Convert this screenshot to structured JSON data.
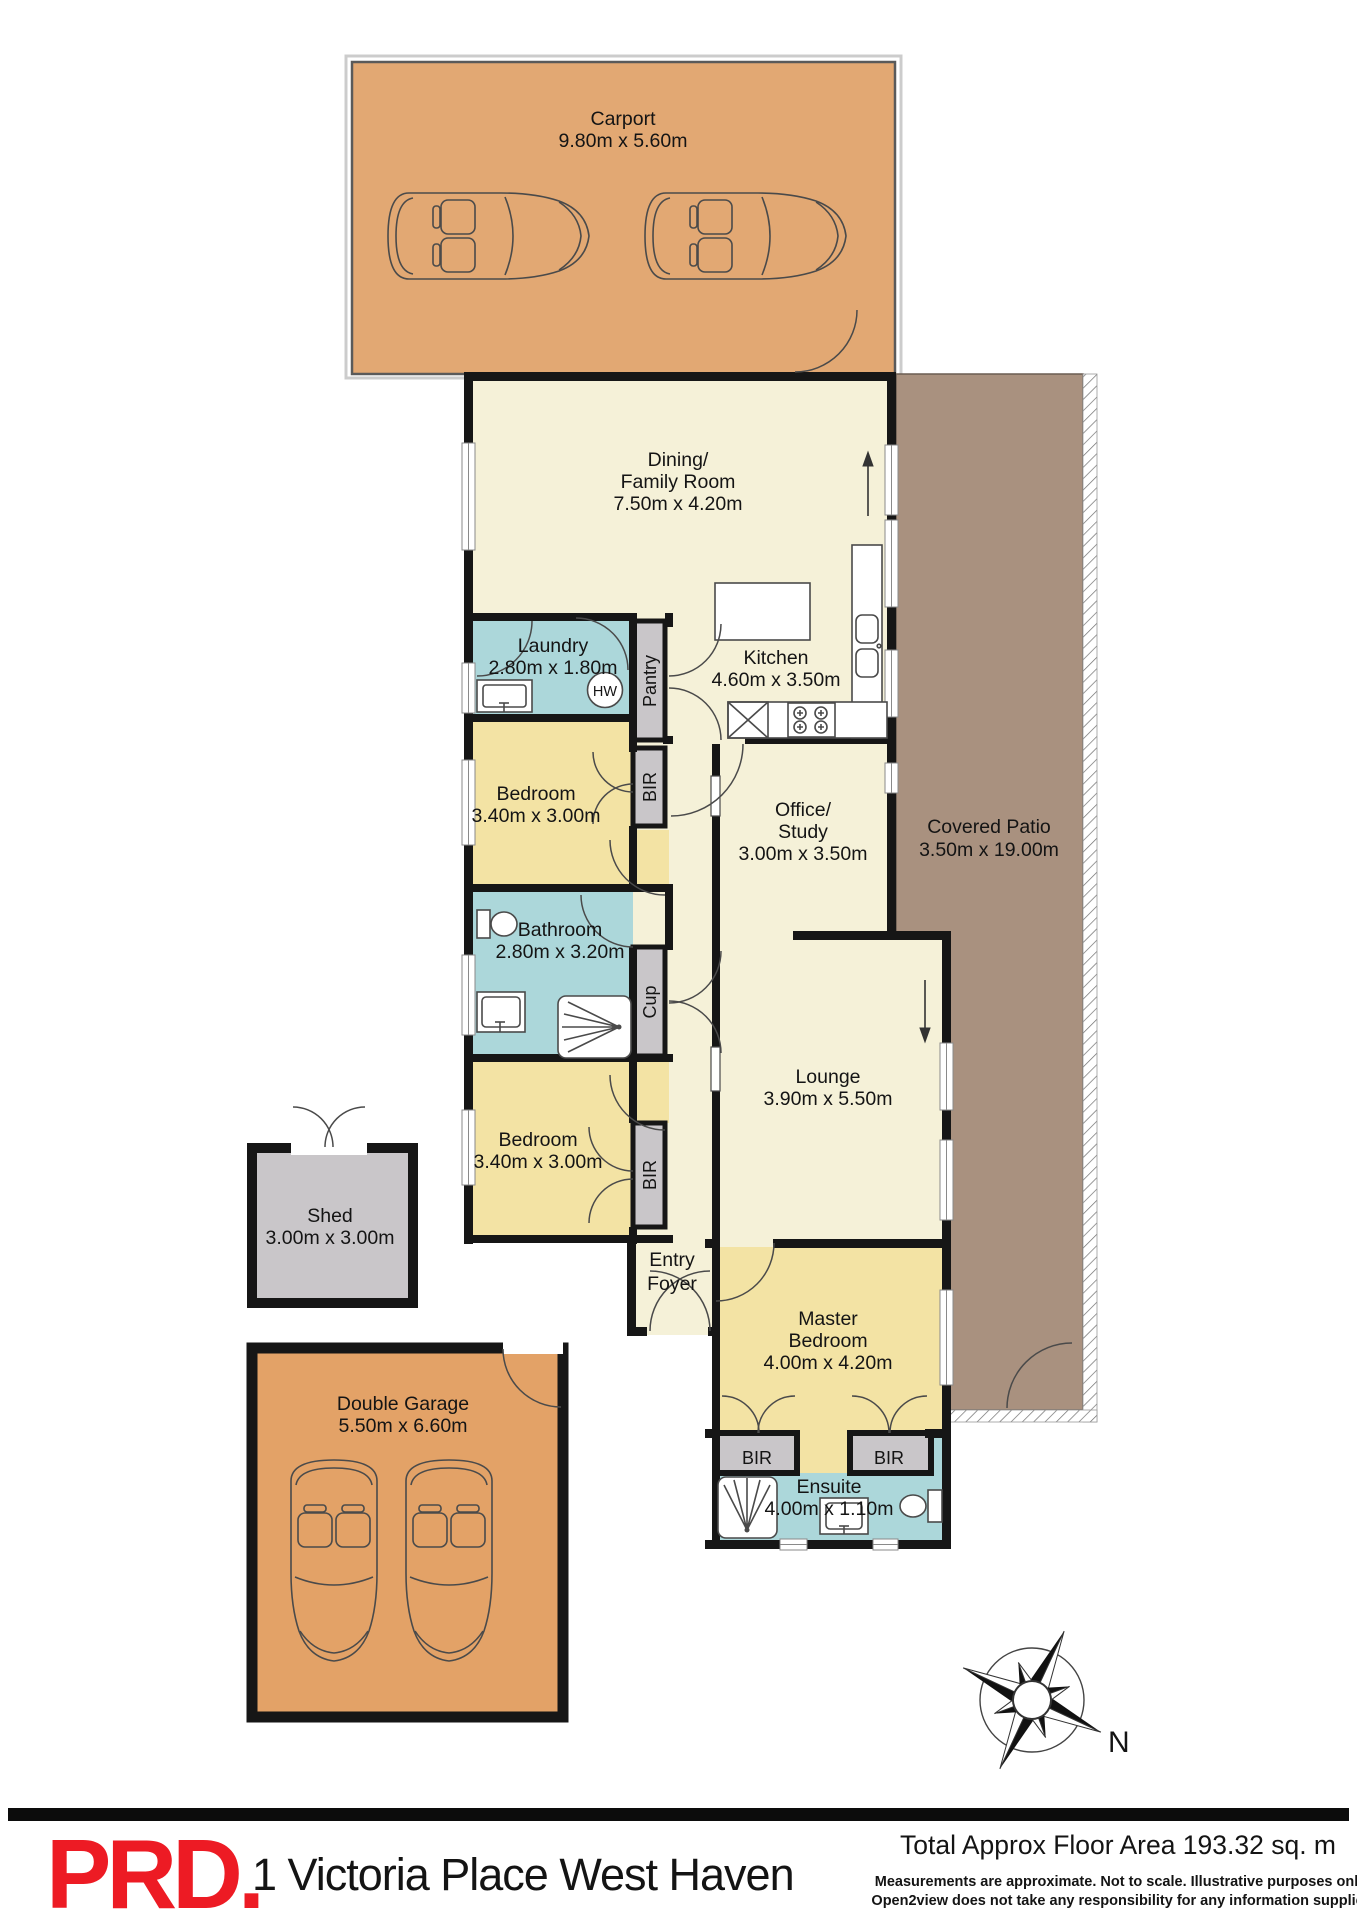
{
  "rooms": {
    "carport": {
      "label": "Carport",
      "dims": "9.80m x 5.60m"
    },
    "dining": {
      "label1": "Dining/",
      "label2": "Family Room",
      "dims": "7.50m x 4.20m"
    },
    "laundry": {
      "label": "Laundry",
      "dims": "2.80m x 1.80m"
    },
    "kitchen": {
      "label": "Kitchen",
      "dims": "4.60m x 3.50m"
    },
    "bedroom1": {
      "label": "Bedroom",
      "dims": "3.40m x 3.00m"
    },
    "bathroom": {
      "label": "Bathroom",
      "dims": "2.80m x 3.20m"
    },
    "office": {
      "label1": "Office/",
      "label2": "Study",
      "dims": "3.00m x 3.50m"
    },
    "covered_patio": {
      "label": "Covered Patio",
      "dims": "3.50m x 19.00m"
    },
    "lounge": {
      "label": "Lounge",
      "dims": "3.90m x 5.50m"
    },
    "bedroom2": {
      "label": "Bedroom",
      "dims": "3.40m x 3.00m"
    },
    "entry_foyer": {
      "label1": "Entry",
      "label2": "Foyer"
    },
    "master_bedroom": {
      "label1": "Master",
      "label2": "Bedroom",
      "dims": "4.00m x 4.20m"
    },
    "ensuite": {
      "label": "Ensuite",
      "dims": "4.00m x 1.10m"
    },
    "shed": {
      "label": "Shed",
      "dims": "3.00m x 3.00m"
    },
    "garage": {
      "label": "Double Garage",
      "dims": "5.50m x 6.60m"
    }
  },
  "closets": {
    "pantry": "Pantry",
    "bir": "BIR",
    "cupboard": "Cup",
    "hot_water": "HW"
  },
  "compass": {
    "north": "N"
  },
  "footer": {
    "brand": "PRD.",
    "address": "1 Victoria Place West Haven",
    "total_area": "Total Approx Floor Area 193.32 sq. m",
    "disclaimer1": "Measurements are approximate. Not to scale. Illustrative purposes only.",
    "disclaimer2": "Open2view does not take any responsibility for any information supplied"
  },
  "palette": {
    "wall": "#161616",
    "cream": "#F5F1D8",
    "yellow": "#F3E3A4",
    "blue": "#ACD7DA",
    "gray": "#C9C6C9",
    "orange": "#E2A873",
    "garage": "#E3A267",
    "patio": "#A9917F",
    "brand": "#ED1B24"
  }
}
